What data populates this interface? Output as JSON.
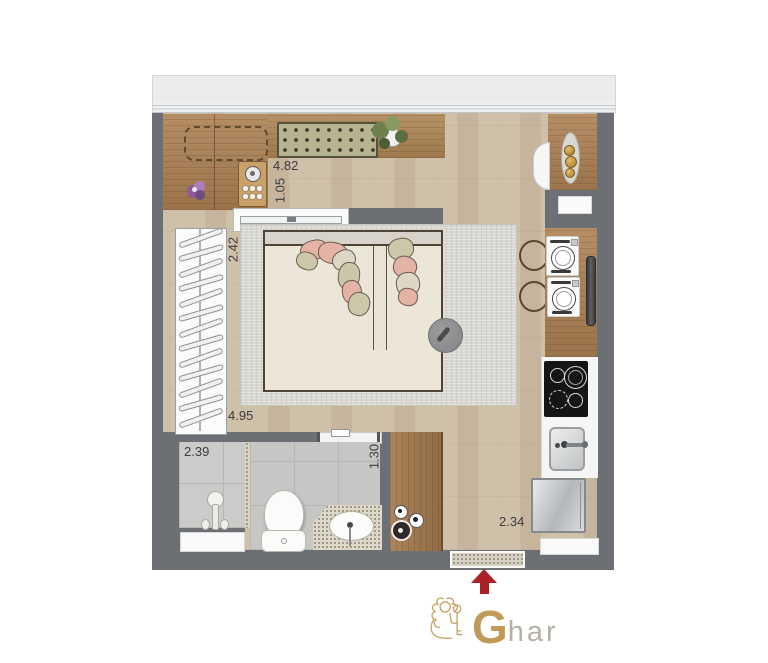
{
  "floorplan": {
    "dimensions": {
      "living_width": "4.82",
      "desk_depth": "1.05",
      "bed_wall": "2.42",
      "living_length": "4.95",
      "bathroom_width": "2.39",
      "bathroom_depth": "1.30",
      "entry_width": "2.34"
    },
    "closet": {
      "hanger_count": 13
    },
    "colors": {
      "wall": "#6c6f73",
      "floor_wood": "#cfc0aa",
      "counter_wood": "#ad8154",
      "rug": "#d9d7d2",
      "entry_arrow": "#ab2126",
      "logo_gold": "#bf9a58",
      "logo_gray": "#b5afa4"
    }
  },
  "logo": {
    "initial": "G",
    "rest": "har"
  }
}
